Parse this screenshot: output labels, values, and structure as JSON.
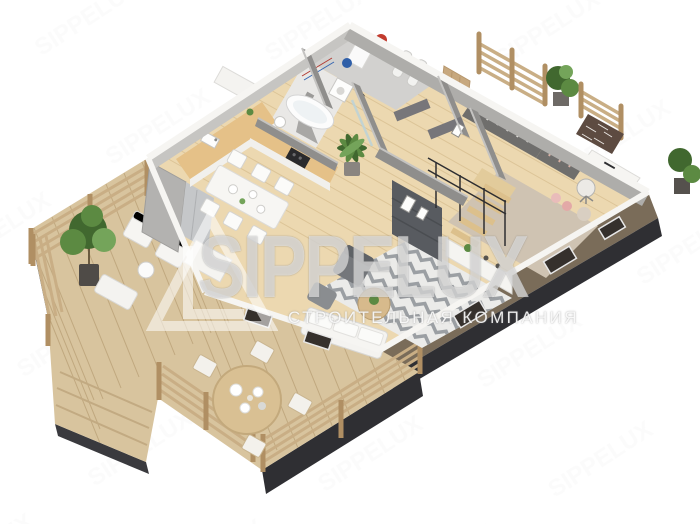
{
  "canvas": {
    "width": 700,
    "height": 524,
    "background": "#ffffff"
  },
  "watermark": {
    "brand": "SIPPELUX",
    "tagline": "СТРОИТЕЛЬНАЯ КОМПАНИЯ",
    "logo": "triangle-L-monogram",
    "text_color": "#ffffff",
    "opacity": 0.55
  },
  "palette": {
    "deck_wood": "#d8c49e",
    "deck_plank_line": "#c0a87f",
    "floor_wood": "#ecd8b0",
    "floor_plank_line": "#dcc497",
    "counter_wood": "#e5c188",
    "wall_white": "#f6f5f2",
    "wall_light": "#c6c5c2",
    "wall_gray": "#aeadaa",
    "partition_dark": "#8f8e8c",
    "exterior_taupe": "#7a6c59",
    "foundation": "#2f2f33",
    "rug_light": "#ebebe9",
    "rug_chevron": "#9b9fa3",
    "office_rug": "#cfc3b2",
    "plant_dark": "#41682f",
    "plant_mid": "#5c8a42",
    "plant_light": "#74a45a",
    "brick": "#5d4b41",
    "metal": "#2e2e31",
    "furniture_white": "#f6f5f2",
    "sofa_gray": "#74777b",
    "media_unit": "#585b60",
    "fridge": "#c5c7c9",
    "boiler_red": "#c23b2e",
    "tank_blue": "#2f5fa8",
    "pink": "#e9bcba"
  },
  "scene": {
    "style": "isometric-3d-render",
    "subject": "single-storey house floor plan with wrap-around wooden terrace",
    "areas": [
      {
        "name": "terrace-lounge",
        "items": [
          "potted-tree",
          "lounge-chairs",
          "coffee-table",
          "wood-railing"
        ]
      },
      {
        "name": "terrace-dining",
        "items": [
          "round-table",
          "four-chairs",
          "wood-railing",
          "steps"
        ]
      },
      {
        "name": "kitchen",
        "items": [
          "tall-cabinets",
          "fridge",
          "l-shaped-counter",
          "cooktop",
          "extractor-hood",
          "sink"
        ]
      },
      {
        "name": "dining-area",
        "items": [
          "table",
          "six-chairs"
        ]
      },
      {
        "name": "bathroom",
        "items": [
          "bathtub",
          "shower",
          "washbasin"
        ]
      },
      {
        "name": "utility-room",
        "items": [
          "boiler",
          "expansion-tank",
          "water-tanks",
          "washing-machine"
        ]
      },
      {
        "name": "hallway",
        "items": [
          "doors",
          "wall-art"
        ]
      },
      {
        "name": "study",
        "items": [
          "corner-bookcase",
          "brick-accent-wall",
          "desk",
          "desk-chair",
          "area-rug",
          "floor-cushions"
        ]
      },
      {
        "name": "living-room",
        "items": [
          "chevron-rug",
          "coffee-table",
          "armchair",
          "sofa",
          "media-wall",
          "sideboard"
        ]
      },
      {
        "name": "stairs",
        "items": [
          "wood-treads",
          "black-railing"
        ]
      },
      {
        "name": "balcony",
        "items": [
          "wood-railings",
          "potted-plant"
        ]
      }
    ]
  }
}
